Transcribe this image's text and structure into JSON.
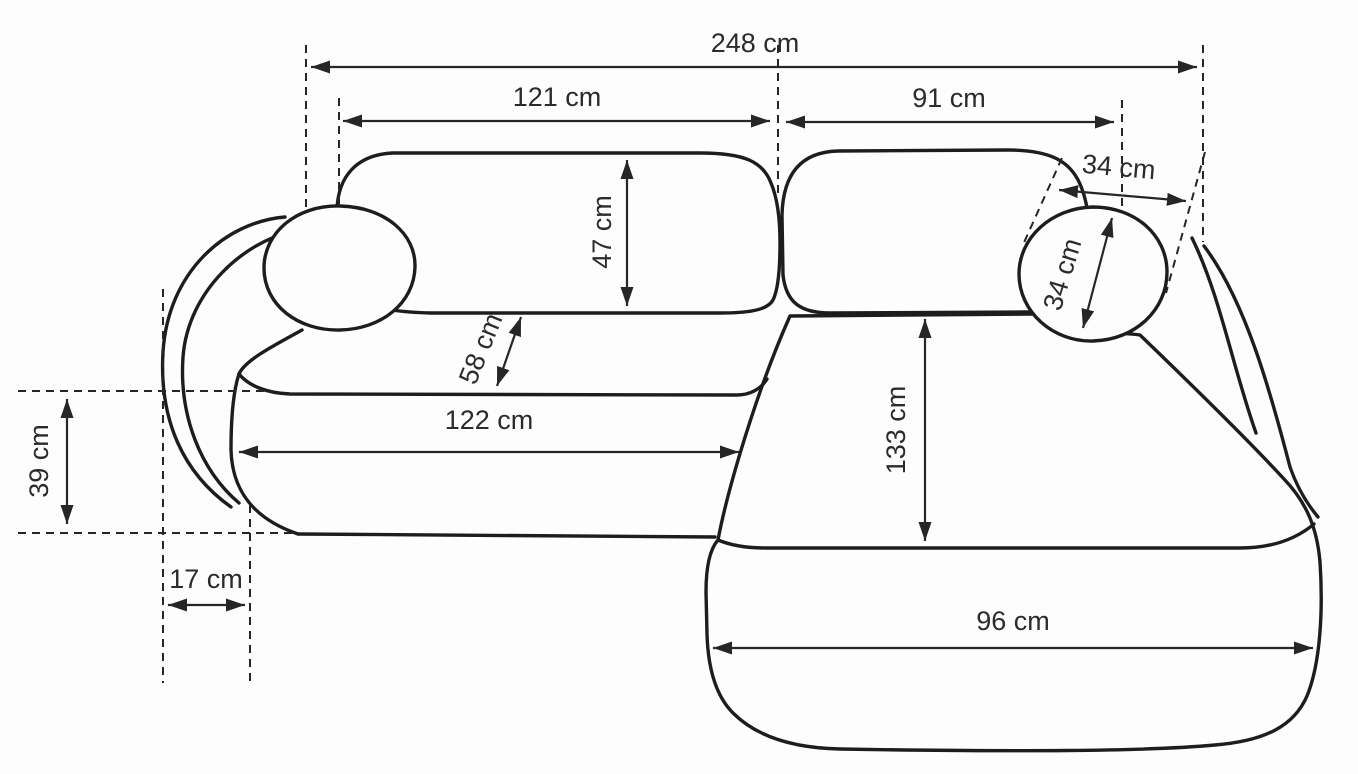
{
  "diagram": {
    "subject": "corner-sofa-dimension-drawing",
    "unit": "cm",
    "dims": {
      "total_width": {
        "text": "248 cm",
        "value": 248
      },
      "left_section_width": {
        "text": "121 cm",
        "value": 121
      },
      "right_section_width": {
        "text": "91 cm",
        "value": 91
      },
      "backrest_depth": {
        "text": "47 cm",
        "value": 47
      },
      "seat_gap_depth": {
        "text": "58 cm",
        "value": 58
      },
      "armrest_top_width": {
        "text": "34 cm",
        "value": 34
      },
      "armrest_cushion": {
        "text": "34 cm",
        "value": 34
      },
      "seat_width": {
        "text": "122 cm",
        "value": 122
      },
      "chaise_depth": {
        "text": "133 cm",
        "value": 133
      },
      "armrest_side_height": {
        "text": "39 cm",
        "value": 39
      },
      "armrest_front_width": {
        "text": "17 cm",
        "value": 17
      },
      "chaise_width": {
        "text": "96 cm",
        "value": 96
      }
    },
    "colors": {
      "line": "#1d1d1d",
      "dimension": "#262626",
      "text": "#2b2b2b",
      "background": "#fdfdfd"
    }
  }
}
